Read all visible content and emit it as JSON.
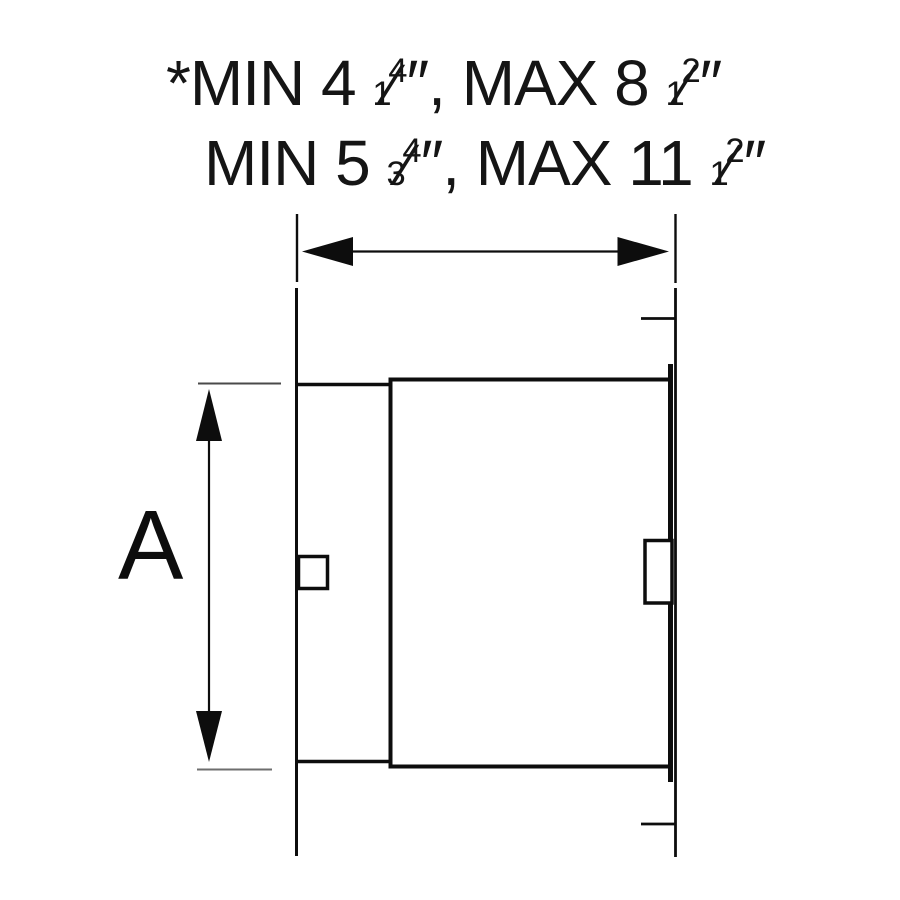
{
  "colors": {
    "background": "#ffffff",
    "line": "#0d0d0d",
    "extension_line_dark": "#4a4a4a",
    "extension_line_light": "#6e6e6e"
  },
  "annotations": {
    "line1": {
      "prefix": "*MIN 4 ",
      "frac1_num": "1",
      "frac1_slash": "⁄",
      "frac1_den": "4",
      "mid": "″, MAX 8 ",
      "frac2_num": "1",
      "frac2_slash": "⁄",
      "frac2_den": "2",
      "suffix": "″"
    },
    "line2": {
      "prefix": "MIN 5 ",
      "frac1_num": "3",
      "frac1_slash": "⁄",
      "frac1_den": "4",
      "mid": "″, MAX 11 ",
      "frac2_num": "1",
      "frac2_slash": "⁄",
      "frac2_den": "2",
      "suffix": "″"
    }
  },
  "dimension_a": {
    "label": "A"
  }
}
